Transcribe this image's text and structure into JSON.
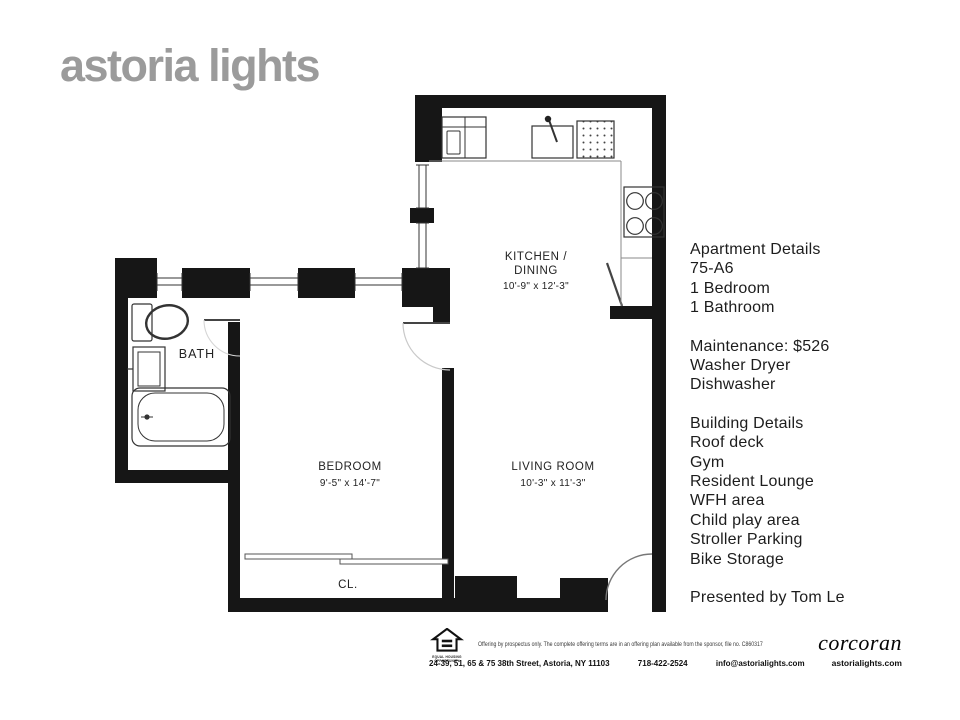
{
  "brand": {
    "logo_text": "astoria lights",
    "logo_color": "#9b9b9b"
  },
  "floorplan": {
    "kitchen": {
      "line1": "KITCHEN /",
      "line2": "DINING",
      "dims": "10'-9\" x 12'-3\""
    },
    "bath": {
      "name": "BATH"
    },
    "bedroom": {
      "name": "BEDROOM",
      "dims": "9'-5\" x 14'-7\""
    },
    "living": {
      "name": "LIVING ROOM",
      "dims": "10'-3\" x 11'-3\""
    },
    "closet": {
      "name": "CL."
    }
  },
  "details": {
    "block1": [
      "Apartment Details",
      "75-A6",
      "1 Bedroom",
      "1 Bathroom"
    ],
    "block2": [
      "Maintenance: $526",
      "Washer Dryer",
      "Dishwasher"
    ],
    "block3": [
      "Building Details",
      "Roof deck",
      "Gym",
      "Resident Lounge",
      "WFH area",
      "Child play area",
      "Stroller Parking",
      "Bike Storage"
    ],
    "block4": [
      "Presented by Tom Le"
    ]
  },
  "footer": {
    "equal_housing_caption": "EQUAL HOUSING OPPORTUNITY",
    "disclaimer": "Offering by prospectus only. The complete offering terms are in an offering plan available from the sponsor, file no. C860317",
    "address": "24-39, 51, 65 & 75  38th Street, Astoria, NY 11103",
    "phone": "718-422-2524",
    "email": "info@astorialights.com",
    "brokerage": "corcoran",
    "website": "astorialights.com"
  },
  "colors": {
    "wall": "#161616",
    "text": "#1c1c1c"
  }
}
